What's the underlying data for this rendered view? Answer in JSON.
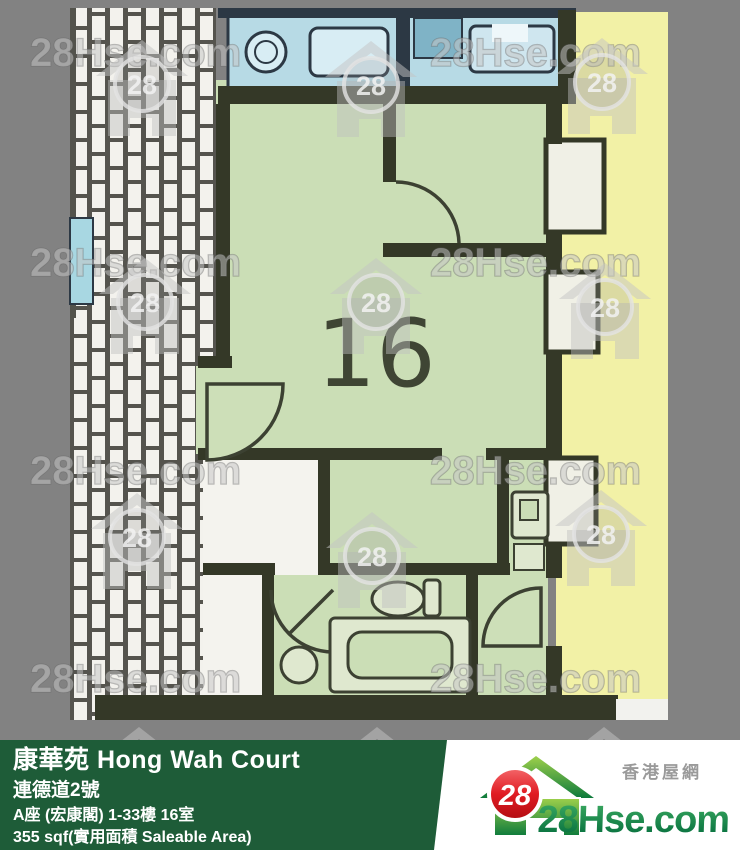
{
  "watermark": {
    "brand": "28Hse.com",
    "logo_number": "28"
  },
  "floor_plan": {
    "unit_label": "16"
  },
  "footer": {
    "building": "康華苑 Hong Wah Court",
    "street": "連德道2號",
    "block_floor_flat": "A座 (宏康閣) 1-33樓 16室",
    "area": "355 sqf(實用面積 Saleable Area)"
  },
  "site_logo": {
    "number": "28",
    "name": "28Hse.com",
    "tagline": "香港屋網"
  },
  "colors": {
    "background_gray": "#828282",
    "room_green": "#cbdeb6",
    "corridor_yellow": "#f2f1a6",
    "fixture_blue": "#b7dae5",
    "wall_dark": "#343827",
    "footer_green": "#1e5c38",
    "logo_red": "#e01b22",
    "logo_green": "#0d7a3c"
  }
}
